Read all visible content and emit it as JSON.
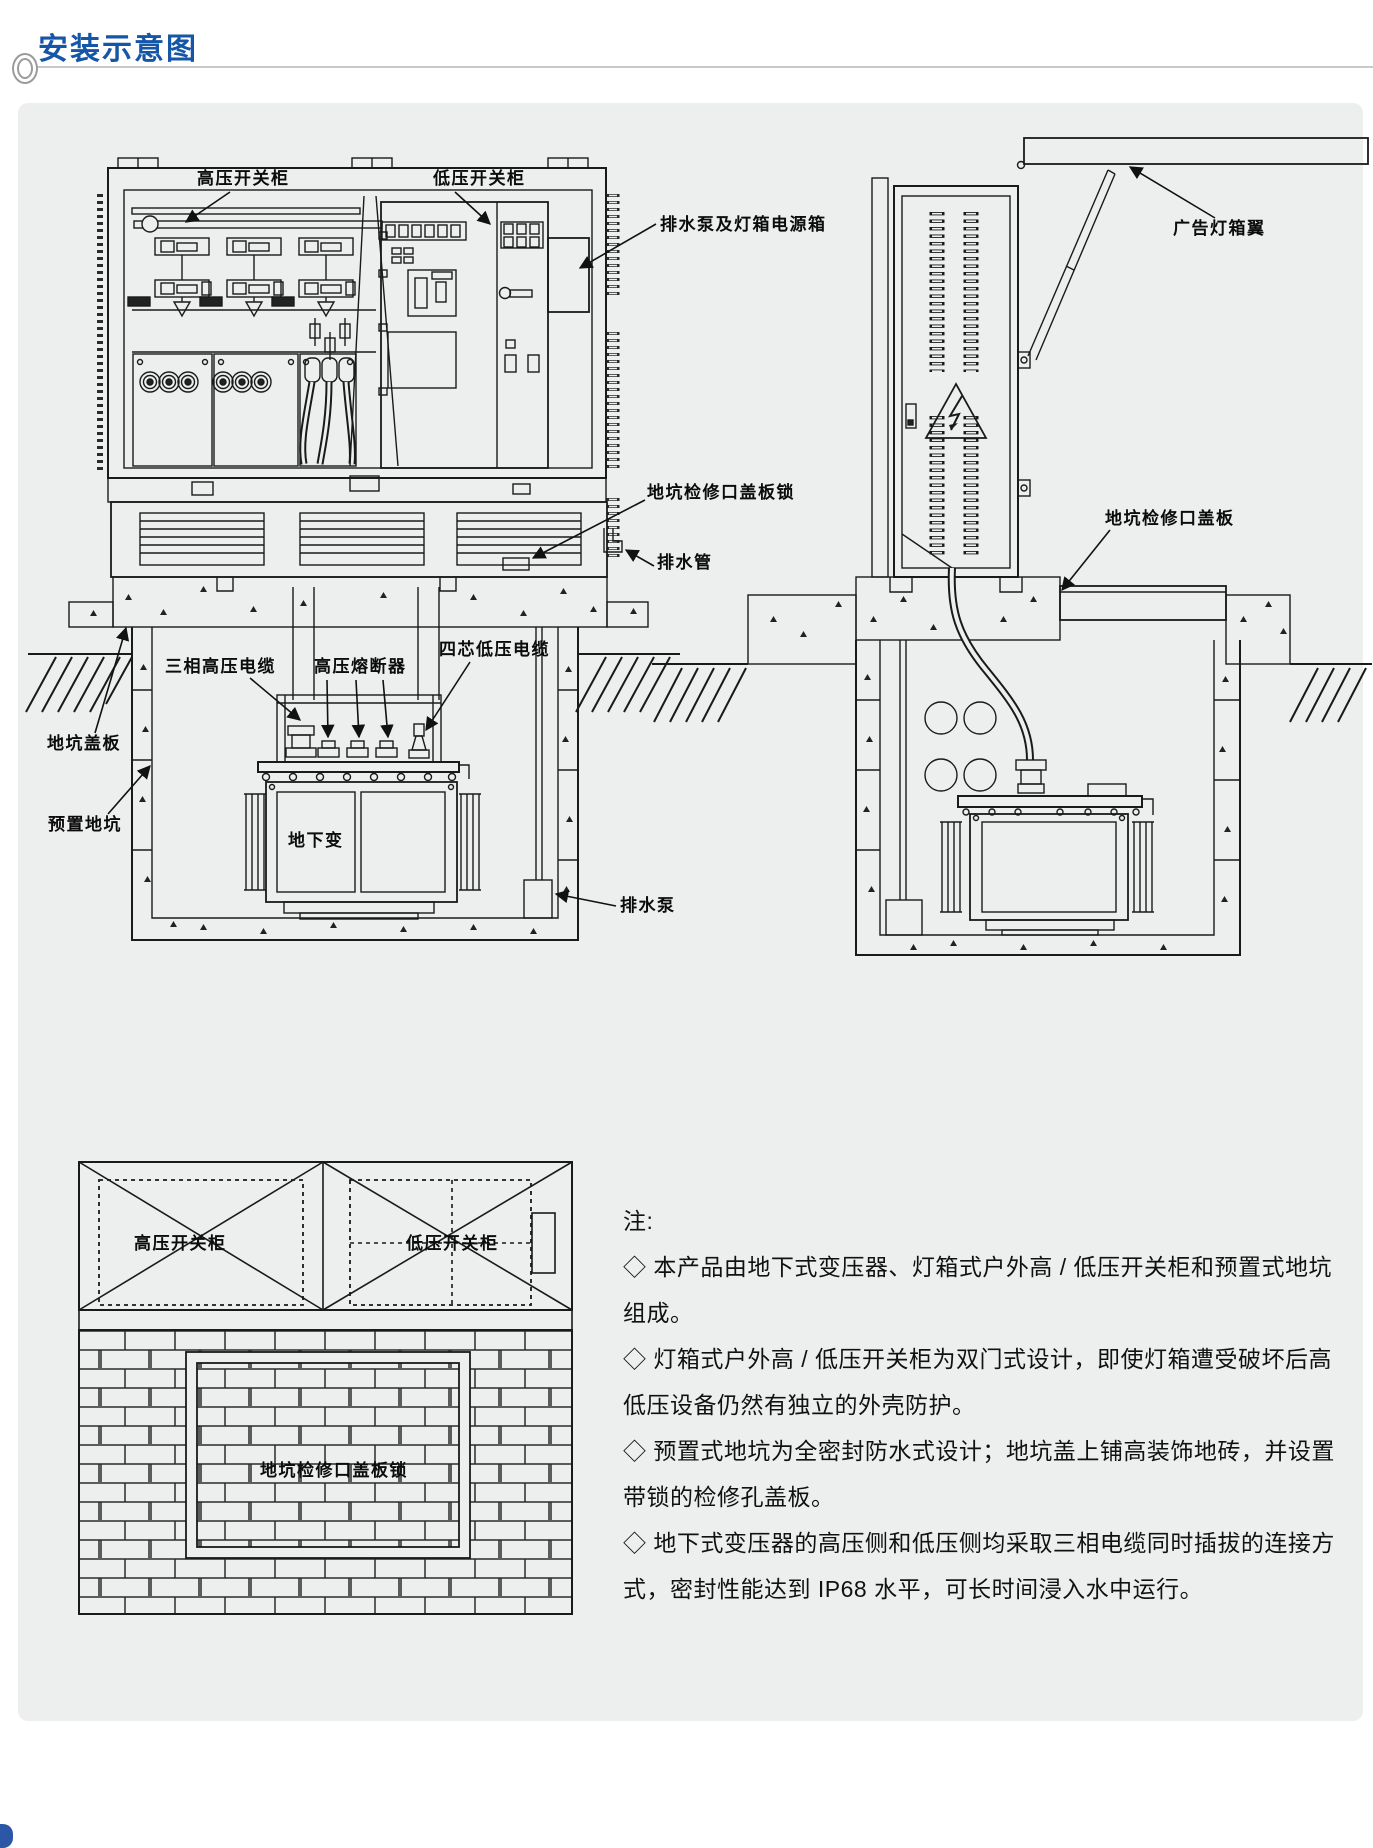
{
  "page": {
    "title": "安装示意图",
    "accent_color": "#1656a6",
    "panel_color": "#edefee",
    "line_color": "#1a1a1a"
  },
  "front_view": {
    "hv_cabinet": "高压开关柜",
    "lv_cabinet": "低压开关柜",
    "pump_lightbox_power_box": "排水泵及灯箱电源箱",
    "pit_access_cover_lock": "地坑检修口盖板锁",
    "drain_pipe": "排水管",
    "three_phase_hv_cable": "三相高压电缆",
    "hv_fuse": "高压熔断器",
    "four_core_lv_cable": "四芯低压电缆",
    "pit_cover": "地坑盖板",
    "preset_pit": "预置地坑",
    "underground_transformer": "地下变",
    "drain_pump": "排水泵"
  },
  "side_view": {
    "ad_lightbox_wing": "广告灯箱翼",
    "pit_access_cover": "地坑检修口盖板"
  },
  "top_view": {
    "hv_cabinet": "高压开关柜",
    "lv_cabinet": "低压开关柜",
    "pit_access_cover_lock": "地坑检修口盖板锁"
  },
  "notes": {
    "heading": "注:",
    "lines": [
      "◇ 本产品由地下式变压器、灯箱式户外高 / 低压开关柜和预置式地坑",
      "组成。",
      "◇ 灯箱式户外高 / 低压开关柜为双门式设计，即使灯箱遭受破坏后高",
      "低压设备仍然有独立的外壳防护。",
      "◇ 预置式地坑为全密封防水式设计；地坑盖上铺高装饰地砖，并设置",
      "带锁的检修孔盖板。",
      "◇ 地下式变压器的高压侧和低压侧均采取三相电缆同时插拔的连接方",
      "式，密封性能达到 IP68 水平，可长时间浸入水中运行。"
    ]
  }
}
